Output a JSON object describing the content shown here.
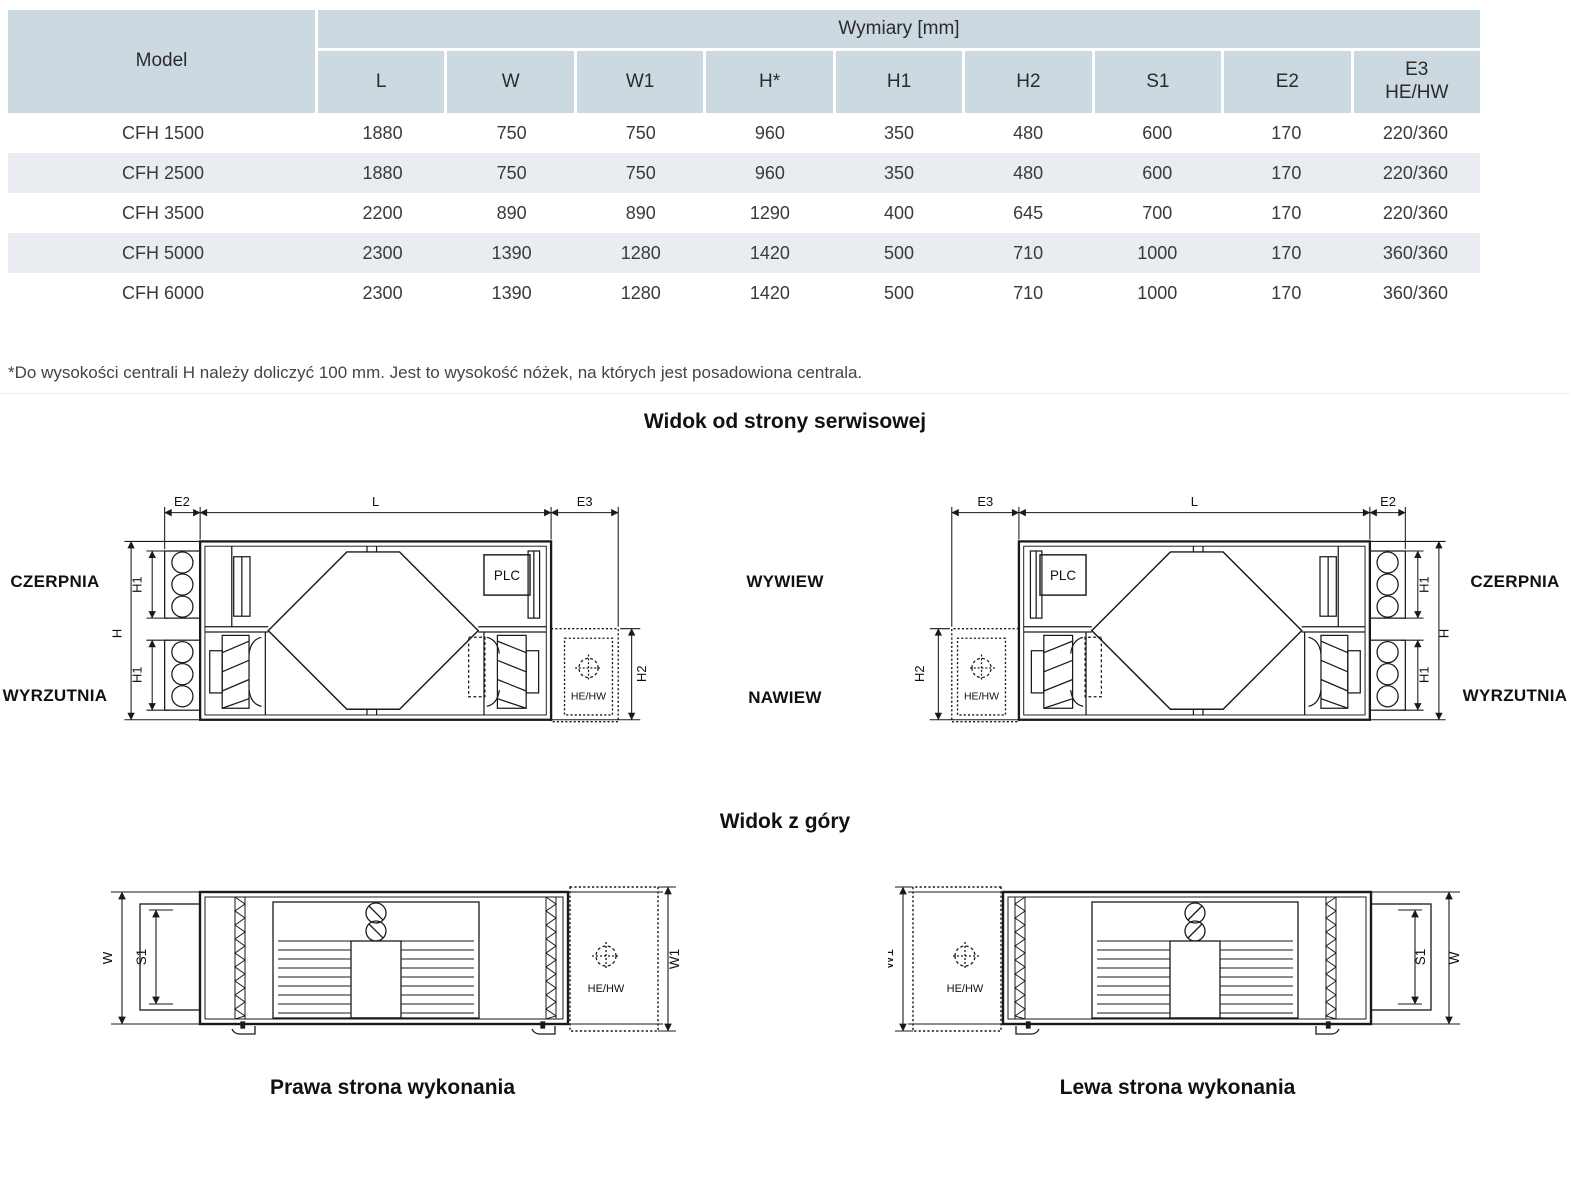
{
  "table": {
    "model_header": "Model",
    "group_header": "Wymiary [mm]",
    "columns": [
      "L",
      "W",
      "W1",
      "H*",
      "H1",
      "H2",
      "S1",
      "E2"
    ],
    "column_e3_line1": "E3",
    "column_e3_line2": "HE/HW",
    "rows": [
      {
        "model": "CFH 1500",
        "values": [
          "1880",
          "750",
          "750",
          "960",
          "350",
          "480",
          "600",
          "170",
          "220/360"
        ]
      },
      {
        "model": "CFH 2500",
        "values": [
          "1880",
          "750",
          "750",
          "960",
          "350",
          "480",
          "600",
          "170",
          "220/360"
        ]
      },
      {
        "model": "CFH 3500",
        "values": [
          "2200",
          "890",
          "890",
          "1290",
          "400",
          "645",
          "700",
          "170",
          "220/360"
        ]
      },
      {
        "model": "CFH 5000",
        "values": [
          "2300",
          "1390",
          "1280",
          "1420",
          "500",
          "710",
          "1000",
          "170",
          "360/360"
        ]
      },
      {
        "model": "CFH 6000",
        "values": [
          "2300",
          "1390",
          "1280",
          "1420",
          "500",
          "710",
          "1000",
          "170",
          "360/360"
        ]
      }
    ]
  },
  "footnote": "*Do wysokości centrali H należy doliczyć 100 mm. Jest to wysokość nóżek, na których jest posadowiona centrala.",
  "sections": {
    "service_view_title": "Widok od strony serwisowej",
    "top_view_title": "Widok z góry",
    "caption_right_side": "Prawa strona wykonania",
    "caption_left_side": "Lewa strona wykonania"
  },
  "side_labels": {
    "intake": "CZERPNIA",
    "discharge": "WYRZUTNIA",
    "extract": "WYWIEW",
    "supply": "NAWIEW"
  },
  "dim_labels": {
    "E2": "E2",
    "L": "L",
    "E3": "E3",
    "H": "H",
    "H1": "H1",
    "H2": "H2",
    "W": "W",
    "W1": "W1",
    "S1": "S1"
  },
  "component_labels": {
    "plc": "PLC",
    "coil": "HE/HW"
  },
  "colors": {
    "header_bg": "#cdd9e0",
    "row_alt_bg": "#e9edf1",
    "text": "#3b3b3b",
    "line": "#1a1a1a"
  }
}
